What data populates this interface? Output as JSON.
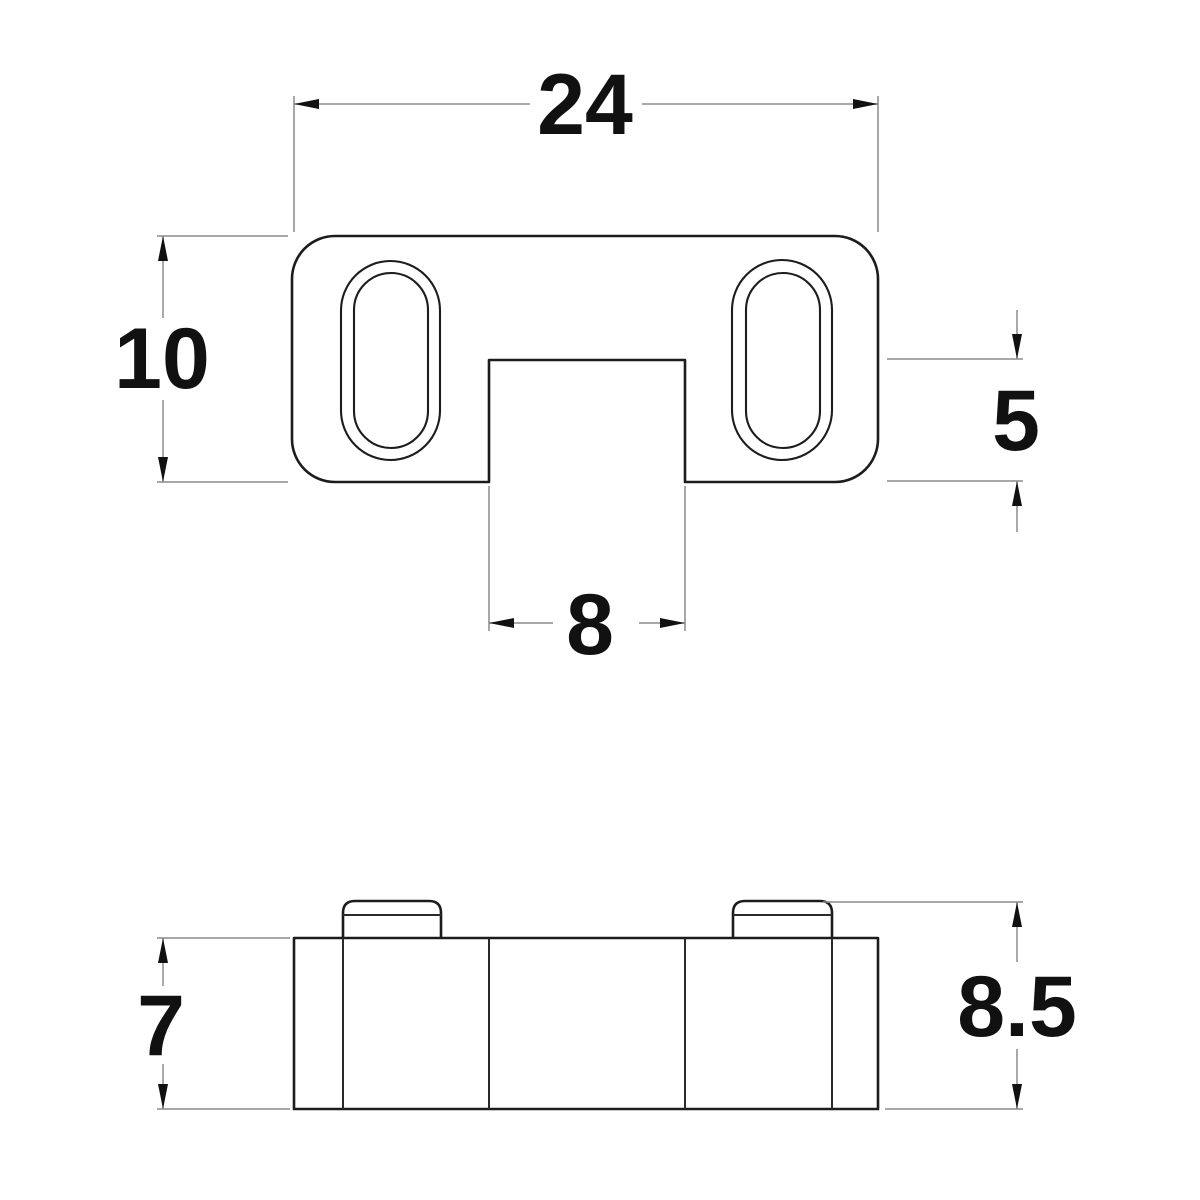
{
  "drawing": {
    "type": "technical-dimension-drawing",
    "background_color": "#ffffff",
    "outline_color": "#1c1c1c",
    "dimension_line_color": "#8c8c8c",
    "text_color": "#111111",
    "views": {
      "top_view": {
        "description": "plate with two oval slots and rectangular bottom notch",
        "slot_count": 2
      },
      "front_view": {
        "description": "base block with two raised rounded bosses"
      }
    },
    "dimensions": {
      "top_width": {
        "value": "24"
      },
      "top_height": {
        "value": "10"
      },
      "notch_depth": {
        "value": "5"
      },
      "notch_width": {
        "value": "8"
      },
      "base_height": {
        "value": "7"
      },
      "overall_height": {
        "value": "8.5"
      }
    }
  }
}
